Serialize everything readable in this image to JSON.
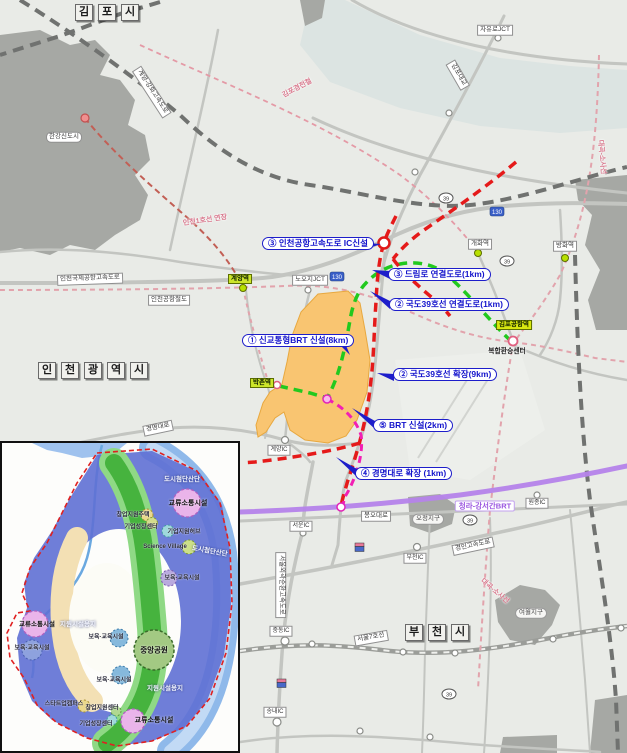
{
  "map": {
    "cities": {
      "gimpo": "김포시",
      "incheon": "인천광역시",
      "bucheon": "부천시"
    },
    "callouts": [
      "③ 인천공항고속도로 IC신설",
      "③ 드림로 연결도로(1km)",
      "② 국도39호선 연결도로(1km)",
      "① 신교통형BRT 신설(8km)",
      "② 국도39호선 확장(9km)",
      "⑤ BRT 신설(2km)",
      "④ 경명대로 확장 (1km)"
    ],
    "roads": {
      "jayuro_jct": "자유로JCT",
      "gimpo_bridge": "김포대교",
      "gyeyang_ganghwa": "계양-강화고속도로",
      "incheon_airport_expwy": "인천국제공항고속도로",
      "airport_rail": "인천공항철도",
      "nooji_jct": "노오지JCT",
      "gyeongmyeong": "경명대로",
      "bongo": "봉오대로",
      "gyeongin_expwy": "경인고속도로",
      "seoul_line7": "서울7호선",
      "outer_ring": "서울외곽순환고속도로",
      "ic_gyeyang": "계양IC",
      "ic_seoun": "서운IC",
      "ic_bucheon": "부천IC",
      "ic_wonjong": "원종IC",
      "ic_jungdong": "중동IC",
      "ic_songnae": "송내IC"
    },
    "districts": {
      "hangang": "한강신도시",
      "ojeong": "오정지구",
      "yeowol": "여월지구",
      "transfer_center": "복합환승센터"
    },
    "rails": {
      "gimpo_lrt": "김포경전철",
      "daegok_sosa": "대곡-소사선",
      "incheon1_ext": "인천1호선 연장",
      "cheongna_gangseo_brt": "청라-강서간BRT"
    },
    "stations": {
      "gyeyang": "계양역",
      "bakchon": "박촌역",
      "gimpo_airport": "김포공항역",
      "gaehwa": "개화역",
      "banghwa": "방화역"
    },
    "shields": {
      "national": "39",
      "expwy": "130"
    }
  },
  "inset": {
    "labels": {
      "high_tech": "도시첨단산단",
      "exchange": "교류소통시설",
      "startup_housing": "창업지원주택",
      "biz_growth": "기업성장센터",
      "biz_hub": "기업지원허브",
      "science_village": "Science Village",
      "childcare": "보육·교육시설",
      "central_park": "중앙공원",
      "support_site": "지원시설용지",
      "startup_campus": "스타트업캠퍼스",
      "startup_center": "창업지원센터"
    }
  },
  "colors": {
    "site_orange": "#F9C571",
    "route_red": "#E51A1A",
    "route_green": "#22C91E",
    "route_magenta": "#F21FB4",
    "brt_purple": "#B583EA",
    "callout_blue": "#1414CC",
    "station_green": "#CDE62A"
  }
}
